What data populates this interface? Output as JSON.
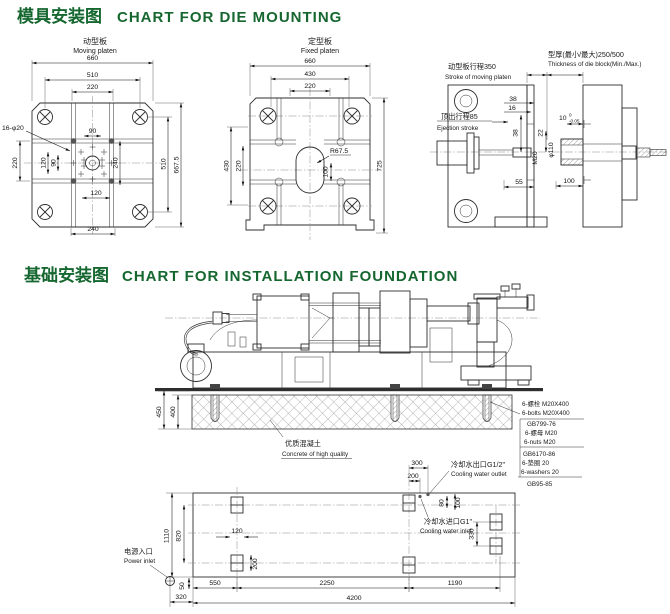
{
  "page": {
    "accent_green": "#15672f",
    "section1": {
      "title_zh": "模具安装图",
      "title_en": "CHART FOR DIE MOUNTING"
    },
    "section2": {
      "title_zh": "基础安装图",
      "title_en": "CHART FOR INSTALLATION FOUNDATION"
    }
  },
  "die_mounting": {
    "moving_platen": {
      "label_zh": "动型板",
      "label_en": "Moving platen",
      "holes_note": "16-φ20",
      "dim_660": "660",
      "dim_510_top": "510",
      "dim_220_top": "220",
      "dim_90_top": "90",
      "dim_220_left": "220",
      "dim_120_left": "120",
      "dim_90_left": "90",
      "dim_240_right": "240",
      "dim_510_right": "510",
      "dim_667": "667.5",
      "dim_120_bottom": "120",
      "dim_240_bottom": "240"
    },
    "fixed_platen": {
      "label_zh": "定型板",
      "label_en": "Fixed platen",
      "dim_660": "660",
      "dim_430_top": "430",
      "dim_220_top": "220",
      "dim_430_left": "430",
      "dim_220_left": "220",
      "dim_725": "725",
      "radius_note": "R67.5",
      "dim_100": "100"
    },
    "side_view": {
      "stroke_zh": "动型板行程350",
      "stroke_en": "Stroke of moving platen",
      "thickness_zh": "型厚(最小/最大)250/500",
      "thickness_en": "Thickness of die block(Min./Max.)",
      "ejection_zh": "顶出行程85",
      "ejection_en": "Ejection stroke",
      "dim_38_a": "38",
      "dim_16": "16",
      "dim_10": "10",
      "tol_hi": "0",
      "tol_lo": "-0.05",
      "dim_22": "22",
      "dim_38_b": "38",
      "thread": "M20",
      "dia": "φ110",
      "dim_55": "55",
      "dim_100": "100"
    }
  },
  "foundation": {
    "concrete_zh": "优质混凝土",
    "concrete_en": "Concrete of high quality",
    "dim_450": "450",
    "dim_400": "400",
    "bom": [
      "6-螺栓 M20X400",
      "6-bolts M20X400",
      "GB799-76",
      "6-螺母 M20",
      "6-nuts M20",
      "GB6170-86",
      "6-垫圈 20",
      "6-washers 20",
      "GB95-85"
    ],
    "plan": {
      "power_zh": "电源入口",
      "power_en": "Power inlet",
      "outlet_zh": "冷却水出口G1/2\"",
      "outlet_en": "Cooling water outlet",
      "inlet_zh": "冷却水进口G1\"",
      "inlet_en": "Cooling water inlet",
      "dim_1110": "1110",
      "dim_820": "820",
      "dim_120": "120",
      "dim_200_pad": "200",
      "dim_300": "300",
      "dim_200_top": "200",
      "dim_80": "80",
      "dim_100": "100",
      "dim_330": "330",
      "dim_50": "50",
      "dim_550": "550",
      "dim_2250": "2250",
      "dim_1190": "1190",
      "dim_320": "320",
      "dim_4200": "4200"
    }
  }
}
